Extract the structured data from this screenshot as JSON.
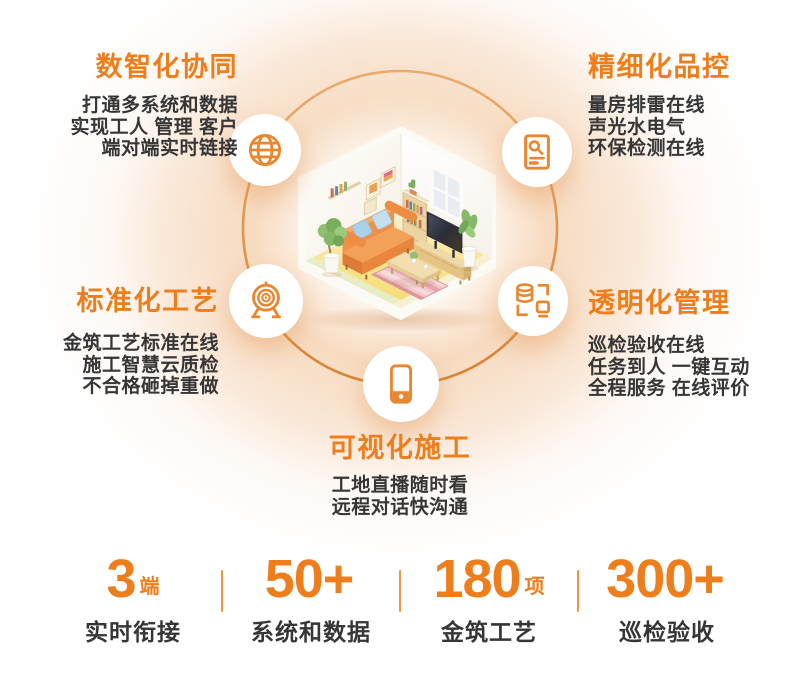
{
  "page": {
    "background": "#FFFFFF",
    "accent_color": "#EE7E1C",
    "icon_color": "#E8872F",
    "ring_color": "#DA8130",
    "text_color": "#363636"
  },
  "features": [
    {
      "position": "top-left",
      "icon": "globe-icon",
      "title": "数智化协同",
      "lines": [
        "打通多系统和数据",
        "实现工人 管理 客户",
        "端对端实时链接"
      ]
    },
    {
      "position": "top-right",
      "icon": "inspection-report-icon",
      "title": "精细化品控",
      "lines": [
        "量房排雷在线",
        "声光水电气",
        "环保检测在线"
      ]
    },
    {
      "position": "middle-left",
      "icon": "target-icon",
      "title": "标准化工艺",
      "lines": [
        "金筑工艺标准在线",
        "施工智慧云质检",
        "不合格砸掉重做"
      ]
    },
    {
      "position": "middle-right",
      "icon": "database-sync-icon",
      "title": "透明化管理",
      "lines": [
        "巡检验收在线",
        "任务到人 一键互动",
        "全程服务 在线评价"
      ]
    },
    {
      "position": "bottom-center",
      "icon": "smartphone-icon",
      "title": "可视化施工",
      "lines": [
        "工地直播随时看",
        "远程对话快沟通"
      ]
    }
  ],
  "stats": [
    {
      "value": "3",
      "unit": "端",
      "label": "实时衔接"
    },
    {
      "value": "50+",
      "unit": "",
      "label": "系统和数据"
    },
    {
      "value": "180",
      "unit": "项",
      "label": "金筑工艺"
    },
    {
      "value": "300+",
      "unit": "",
      "label": "巡检验收"
    }
  ],
  "illustration": {
    "name": "isometric-living-room",
    "elements": [
      "sofa",
      "tv",
      "tv-console",
      "bookshelf",
      "window",
      "coffee-table",
      "striped-rug",
      "potted-plants",
      "wall-frames"
    ]
  }
}
